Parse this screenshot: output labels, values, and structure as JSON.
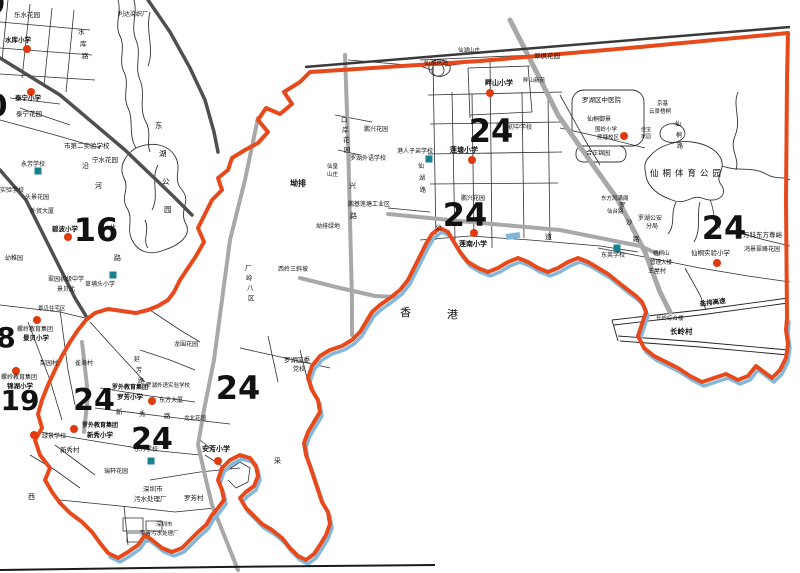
{
  "map_region": "罗湖区 / 香港 边界地图",
  "colors": {
    "boundary": "#e8491a",
    "top_line": "#3a3a3a",
    "water": "#82b8dc",
    "road_gray": "#a8a8a8",
    "road_dark": "#4f4f4f",
    "street": "#2f2f2f",
    "marker_red": "#e03a0f",
    "marker_teal": "#15808e",
    "text": "#111111",
    "frame": "#1a1a1a"
  },
  "hk_label": {
    "char1": "香",
    "char2": "港"
  },
  "district_numbers": [
    {
      "t": "9",
      "x": -5,
      "y": 14,
      "s": 30
    },
    {
      "t": "0",
      "x": -3,
      "y": 116,
      "s": 30
    },
    {
      "t": "8",
      "x": 6,
      "y": 347,
      "s": 28
    },
    {
      "t": "19",
      "x": 20,
      "y": 410,
      "s": 28
    },
    {
      "t": "16",
      "x": 96,
      "y": 241,
      "s": 32
    },
    {
      "t": "24",
      "x": 491,
      "y": 142,
      "s": 32
    },
    {
      "t": "24",
      "x": 465,
      "y": 226,
      "s": 32
    },
    {
      "t": "24",
      "x": 724,
      "y": 239,
      "s": 32
    },
    {
      "t": "24",
      "x": 238,
      "y": 399,
      "s": 32
    },
    {
      "t": "24",
      "x": 94,
      "y": 410,
      "s": 30
    },
    {
      "t": "24",
      "x": 152,
      "y": 449,
      "s": 30
    }
  ],
  "schools": {
    "red": [
      {
        "name": "水库小学",
        "dot": [
          27,
          49
        ],
        "lines": [
          {
            "t": "水库小学",
            "x": 5,
            "y": 42,
            "s": 6.5,
            "b": 1
          }
        ]
      },
      {
        "name": "泰宁小学",
        "dot": [
          31,
          92
        ],
        "lines": [
          {
            "t": "泰宁小学",
            "x": 15,
            "y": 100,
            "s": 6.5,
            "b": 1
          }
        ]
      },
      {
        "name": "碧波小学",
        "dot": [
          68,
          237
        ],
        "lines": [
          {
            "t": "碧波小学",
            "x": 52,
            "y": 231,
            "s": 6.5,
            "b": 1
          }
        ]
      },
      {
        "name": "螺岭教育集团景贝小学",
        "dot": [
          37,
          320
        ],
        "lines": [
          {
            "t": "螺岭教育集团",
            "x": 17,
            "y": 331,
            "s": 6
          },
          {
            "t": "景贝小学",
            "x": 23,
            "y": 340,
            "s": 6.5,
            "b": 1
          }
        ]
      },
      {
        "name": "螺岭教育集团锦湖小学",
        "dot": [
          16,
          371
        ],
        "lines": [
          {
            "t": "螺岭教育集团",
            "x": 1,
            "y": 379,
            "s": 6
          },
          {
            "t": "锦湖小学",
            "x": 7,
            "y": 388,
            "s": 6.5,
            "b": 1
          }
        ]
      },
      {
        "name": "罗外教育集团罗芳小学",
        "dot": [
          152,
          401
        ],
        "lines": [
          {
            "t": "罗外教育集团",
            "x": 112,
            "y": 389,
            "s": 6,
            "b": 1
          },
          {
            "t": "罗芳小学",
            "x": 117,
            "y": 399,
            "s": 6.5,
            "b": 1
          }
        ]
      },
      {
        "name": "罗外教育集团新秀小学",
        "dot": [
          74,
          429
        ],
        "lines": [
          {
            "t": "罗外教育集团",
            "x": 82,
            "y": 427,
            "s": 6,
            "b": 1
          },
          {
            "t": "新秀小学",
            "x": 87,
            "y": 437,
            "s": 6.5,
            "b": 1
          }
        ]
      },
      {
        "name": "绿景学校",
        "dot": [
          34,
          435
        ],
        "lines": [
          {
            "t": "绿景学校",
            "x": 42,
            "y": 438,
            "s": 6
          }
        ]
      },
      {
        "name": "安芳小学",
        "dot": [
          218,
          461
        ],
        "lines": [
          {
            "t": "安芳小学",
            "x": 202,
            "y": 451,
            "s": 7,
            "b": 1
          }
        ]
      },
      {
        "name": "莲塘小学",
        "dot": [
          472,
          160
        ],
        "lines": [
          {
            "t": "莲塘小学",
            "x": 450,
            "y": 152,
            "s": 7,
            "b": 1
          }
        ]
      },
      {
        "name": "畔山小学",
        "dot": [
          490,
          93
        ],
        "lines": [
          {
            "t": "畔山小学",
            "x": 485,
            "y": 85,
            "s": 7,
            "b": 1
          }
        ]
      },
      {
        "name": "莲南小学",
        "dot": [
          474,
          233
        ],
        "lines": [
          {
            "t": "莲南小学",
            "x": 459,
            "y": 246,
            "s": 7,
            "b": 1
          }
        ]
      },
      {
        "name": "围岭小学莲塘校区",
        "dot": [
          624,
          136
        ],
        "lines": [
          {
            "t": "围岭小学",
            "x": 595,
            "y": 131,
            "s": 5.5
          },
          {
            "t": "莲塘校区",
            "x": 597,
            "y": 139,
            "s": 5.5
          }
        ]
      },
      {
        "name": "仙桐实验小学",
        "dot": [
          717,
          263
        ],
        "lines": [
          {
            "t": "仙桐实验小学",
            "x": 691,
            "y": 255,
            "s": 6.5
          }
        ]
      }
    ],
    "teal": [
      {
        "name": "永芳学校",
        "sq": [
          38,
          171
        ],
        "lines": [
          {
            "t": "永芳学校",
            "x": 21,
            "y": 166,
            "s": 6
          }
        ]
      },
      {
        "name": "草埔头小学",
        "sq": [
          113,
          275
        ],
        "lines": [
          {
            "t": "草埔头小学",
            "x": 85,
            "y": 286,
            "s": 6
          }
        ]
      },
      {
        "name": "港人子弟学校",
        "sq": [
          429,
          159
        ],
        "lines": [
          {
            "t": "港人子弟学校",
            "x": 397,
            "y": 153,
            "s": 6
          }
        ]
      },
      {
        "name": "东英学校",
        "sq": [
          617,
          248
        ],
        "lines": [
          {
            "t": "东英学校",
            "x": 601,
            "y": 257,
            "s": 6
          }
        ]
      },
      {
        "name": "东方学校",
        "sq": [
          151,
          461
        ],
        "lines": [
          {
            "t": "东方学校",
            "x": 134,
            "y": 451,
            "s": 6
          }
        ]
      }
    ]
  },
  "labels": [
    {
      "t": "乐水花园",
      "x": 14,
      "y": 17,
      "s": 6.5
    },
    {
      "t": "利达染织厂",
      "x": 118,
      "y": 16,
      "s": 6
    },
    {
      "t": "水",
      "x": 78,
      "y": 34,
      "s": 6.5
    },
    {
      "t": "库",
      "x": 80,
      "y": 46,
      "s": 6.5
    },
    {
      "t": "路",
      "x": 82,
      "y": 58,
      "s": 6.5
    },
    {
      "t": "泰宁花园",
      "x": 16,
      "y": 116,
      "s": 6.5
    },
    {
      "t": "市第二实验学校",
      "x": 64,
      "y": 148,
      "s": 6.5
    },
    {
      "t": "东",
      "x": 155,
      "y": 128,
      "s": 7.5
    },
    {
      "t": "湖",
      "x": 159,
      "y": 156,
      "s": 7.5
    },
    {
      "t": "公",
      "x": 162,
      "y": 184,
      "s": 7.5
    },
    {
      "t": "园",
      "x": 164,
      "y": 212,
      "s": 7.5
    },
    {
      "t": "宁水花园",
      "x": 92,
      "y": 162,
      "s": 6.5
    },
    {
      "t": "沿",
      "x": 82,
      "y": 168,
      "s": 7
    },
    {
      "t": "河",
      "x": 95,
      "y": 188,
      "s": 7
    },
    {
      "t": "北",
      "x": 109,
      "y": 230,
      "s": 7
    },
    {
      "t": "路",
      "x": 114,
      "y": 260,
      "s": 7
    },
    {
      "t": "头景花园",
      "x": 25,
      "y": 199,
      "s": 6
    },
    {
      "t": "外贸大厦",
      "x": 30,
      "y": 213,
      "s": 6
    },
    {
      "t": "实验学校",
      "x": 0,
      "y": 192,
      "s": 6
    },
    {
      "t": "幼稚园",
      "x": 5,
      "y": 260,
      "s": 6
    },
    {
      "t": "翠园初级中学",
      "x": 48,
      "y": 281,
      "s": 6
    },
    {
      "t": "景贝北",
      "x": 57,
      "y": 291,
      "s": 6
    },
    {
      "t": "景贝住宅区",
      "x": 38,
      "y": 310,
      "s": 5.5
    },
    {
      "t": "口",
      "x": 341,
      "y": 122,
      "s": 6.5
    },
    {
      "t": "岸",
      "x": 342,
      "y": 132,
      "s": 6.5
    },
    {
      "t": "花",
      "x": 343,
      "y": 142,
      "s": 6.5
    },
    {
      "t": "园",
      "x": 344,
      "y": 152,
      "s": 6.5
    },
    {
      "t": "鹏兴花园",
      "x": 364,
      "y": 131,
      "s": 6
    },
    {
      "t": "罗湖外语学校",
      "x": 350,
      "y": 160,
      "s": 6
    },
    {
      "t": "仙皇",
      "x": 327,
      "y": 168,
      "s": 5.5
    },
    {
      "t": "山庄",
      "x": 327,
      "y": 176,
      "s": 5.5
    },
    {
      "t": "兴",
      "x": 349,
      "y": 188,
      "s": 7
    },
    {
      "t": "路",
      "x": 350,
      "y": 218,
      "s": 7
    },
    {
      "t": "坳排",
      "x": 290,
      "y": 186,
      "s": 8,
      "b": 1
    },
    {
      "t": "鹏基莲塘工业区",
      "x": 348,
      "y": 206,
      "s": 6
    },
    {
      "t": "坳排绿地",
      "x": 316,
      "y": 228,
      "s": 6
    },
    {
      "t": "西岭三斜坡",
      "x": 278,
      "y": 271,
      "s": 6
    },
    {
      "t": "厂",
      "x": 245,
      "y": 270,
      "s": 6.5
    },
    {
      "t": "岭",
      "x": 246,
      "y": 280,
      "s": 6.5
    },
    {
      "t": "八",
      "x": 247,
      "y": 290,
      "s": 6.5
    },
    {
      "t": "区",
      "x": 248,
      "y": 300,
      "s": 6.5
    },
    {
      "t": "仙湖总站",
      "x": 424,
      "y": 65,
      "s": 6
    },
    {
      "t": "仙湖山庄",
      "x": 458,
      "y": 52,
      "s": 5.5
    },
    {
      "t": "翠枫花园",
      "x": 534,
      "y": 58,
      "s": 6.5
    },
    {
      "t": "畔山新苑",
      "x": 523,
      "y": 82,
      "s": 5.5
    },
    {
      "t": "罗外初中学校",
      "x": 496,
      "y": 129,
      "s": 6
    },
    {
      "t": "罗湖区中医院",
      "x": 582,
      "y": 102,
      "s": 6.5
    },
    {
      "t": "仙桐御景",
      "x": 587,
      "y": 121,
      "s": 6
    },
    {
      "t": "京基",
      "x": 657,
      "y": 105,
      "s": 5.5
    },
    {
      "t": "云景梧桐",
      "x": 649,
      "y": 113,
      "s": 5.5
    },
    {
      "t": "仙",
      "x": 675,
      "y": 126,
      "s": 6
    },
    {
      "t": "桐",
      "x": 676,
      "y": 137,
      "s": 6
    },
    {
      "t": "路",
      "x": 677,
      "y": 148,
      "s": 6
    },
    {
      "t": "合正锦园",
      "x": 586,
      "y": 155,
      "s": 6
    },
    {
      "t": "佳宝",
      "x": 641,
      "y": 131,
      "s": 5
    },
    {
      "t": "家园",
      "x": 641,
      "y": 138,
      "s": 5
    },
    {
      "t": "仙桐体育公园",
      "x": 650,
      "y": 176,
      "s": 8.5,
      "ls": 4
    },
    {
      "t": "东方风满阁",
      "x": 601,
      "y": 200,
      "s": 5.5
    },
    {
      "t": "仙台路",
      "x": 607,
      "y": 213,
      "s": 5.5
    },
    {
      "t": "罗湖公安",
      "x": 638,
      "y": 220,
      "s": 6
    },
    {
      "t": "分局",
      "x": 646,
      "y": 228,
      "s": 6
    },
    {
      "t": "梧桐山",
      "x": 653,
      "y": 255,
      "s": 5.5
    },
    {
      "t": "管理大楼",
      "x": 650,
      "y": 264,
      "s": 5.5
    },
    {
      "t": "王屋村",
      "x": 648,
      "y": 273,
      "s": 6
    },
    {
      "t": "罗",
      "x": 619,
      "y": 207,
      "s": 6.5
    },
    {
      "t": "沙",
      "x": 626,
      "y": 224,
      "s": 6.5
    },
    {
      "t": "路",
      "x": 633,
      "y": 241,
      "s": 6.5
    },
    {
      "t": "万科东方尊峪",
      "x": 743,
      "y": 237,
      "s": 6.5
    },
    {
      "t": "鸿景翠峰花园",
      "x": 744,
      "y": 251,
      "s": 6
    },
    {
      "t": "公",
      "x": 435,
      "y": 230,
      "s": 7
    },
    {
      "t": "道",
      "x": 545,
      "y": 239,
      "s": 7
    },
    {
      "t": "仙",
      "x": 418,
      "y": 168,
      "s": 6
    },
    {
      "t": "湖",
      "x": 419,
      "y": 180,
      "s": 6
    },
    {
      "t": "路",
      "x": 420,
      "y": 192,
      "s": 6
    },
    {
      "t": "鹏兴花园",
      "x": 461,
      "y": 200,
      "s": 6
    },
    {
      "t": "香",
      "x": 400,
      "y": 316,
      "s": 11
    },
    {
      "t": "港",
      "x": 447,
      "y": 318,
      "s": 11
    },
    {
      "t": "罗湖区委",
      "x": 284,
      "y": 362,
      "s": 6.5
    },
    {
      "t": "党校",
      "x": 293,
      "y": 371,
      "s": 6
    },
    {
      "t": "罗湖外语实验学校",
      "x": 146,
      "y": 387,
      "s": 5.5
    },
    {
      "t": "东方大厦",
      "x": 159,
      "y": 402,
      "s": 6
    },
    {
      "t": "新",
      "x": 116,
      "y": 414,
      "s": 6.5
    },
    {
      "t": "秀",
      "x": 139,
      "y": 416,
      "s": 6.5
    },
    {
      "t": "路",
      "x": 164,
      "y": 418,
      "s": 6.5
    },
    {
      "t": "龙北花园",
      "x": 184,
      "y": 420,
      "s": 5.5
    },
    {
      "t": "龙围花园",
      "x": 174,
      "y": 346,
      "s": 6
    },
    {
      "t": "梨园村",
      "x": 40,
      "y": 365,
      "s": 6
    },
    {
      "t": "雀海村",
      "x": 75,
      "y": 365,
      "s": 6
    },
    {
      "t": "延",
      "x": 134,
      "y": 361,
      "s": 6
    },
    {
      "t": "芳",
      "x": 136,
      "y": 372,
      "s": 6
    },
    {
      "t": "路",
      "x": 138,
      "y": 383,
      "s": 6
    },
    {
      "t": "西",
      "x": 28,
      "y": 499,
      "s": 7
    },
    {
      "t": "新秀村",
      "x": 60,
      "y": 452,
      "s": 6.5
    },
    {
      "t": "瑞轩花园",
      "x": 104,
      "y": 473,
      "s": 6
    },
    {
      "t": "深圳市",
      "x": 143,
      "y": 491,
      "s": 6.5
    },
    {
      "t": "污水处理厂",
      "x": 134,
      "y": 501,
      "s": 6.5
    },
    {
      "t": "罗芳村",
      "x": 184,
      "y": 500,
      "s": 6.5
    },
    {
      "t": "深圳市",
      "x": 156,
      "y": 526,
      "s": 5.5
    },
    {
      "t": "罗芳污水处理厂",
      "x": 140,
      "y": 535,
      "s": 5.5
    },
    {
      "t": "采",
      "x": 274,
      "y": 463,
      "s": 7
    },
    {
      "t": "长岭村",
      "x": 670,
      "y": 334,
      "s": 7.5,
      "b": 1
    },
    {
      "t": "长岭综合楼",
      "x": 656,
      "y": 320,
      "s": 5.5
    },
    {
      "t": "盐排高速",
      "x": 700,
      "y": 306,
      "s": 6.5,
      "b": 1,
      "r": -7
    }
  ]
}
